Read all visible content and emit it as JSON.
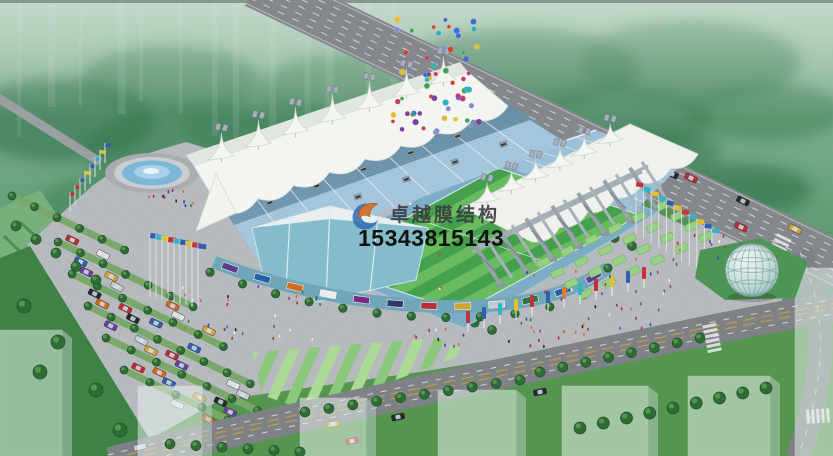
{
  "image": {
    "title": "stadium-aerial-rendering",
    "type": "architectural rendering (aerial view of tensile membrane roof stadium)",
    "watermark": {
      "brand": "卓越膜结构",
      "phone": "15343815143"
    },
    "palette": {
      "membrane": "#f3f5f1",
      "seat_upper": "#6d99b2",
      "seat_lower": "#a7c9df",
      "seat_wave": "#c6e0ee",
      "pitch_dark": "#44a04c",
      "pitch_light": "#68bb5e",
      "deck_blue": "#7cadc6",
      "plaza": "#b7bbbf",
      "road": "#84888d",
      "forest": "#4f8f66",
      "dome": "#cfe6e2",
      "steel": "#99a2ac",
      "watermark_text": "#3a3a40",
      "watermark_phone": "#121212",
      "logo_blue": "#2e6cb5",
      "logo_orange": "#d2702a",
      "balloons": [
        "#3b6fd4",
        "#c03a6a",
        "#7a3fa0",
        "#40a050",
        "#e0c030",
        "#30b0c0",
        "#d04030",
        "#8888cc"
      ],
      "flags": [
        "#c23236",
        "#2e5fb0",
        "#30b4c8",
        "#e0c030",
        "#e07830"
      ],
      "cars": [
        "#b93032",
        "#2e5fb0",
        "#e2e2e2",
        "#d2a43c",
        "#d2691e",
        "#6a3fa0",
        "#26282a",
        "#c8ccd0"
      ],
      "ads": [
        "#5b3e8f",
        "#2a5fa8",
        "#d2691e",
        "#ececec",
        "#7a2a80",
        "#35356d",
        "#b93032",
        "#d4a030",
        "#c8c8d0",
        "#2e7050",
        "#2a5fa8",
        "#5b3e8f"
      ],
      "people": [
        "#b03038",
        "#2b4fa0",
        "#ececec",
        "#23262a",
        "#d07030",
        "#3a7a40",
        "#8048a0"
      ]
    }
  }
}
